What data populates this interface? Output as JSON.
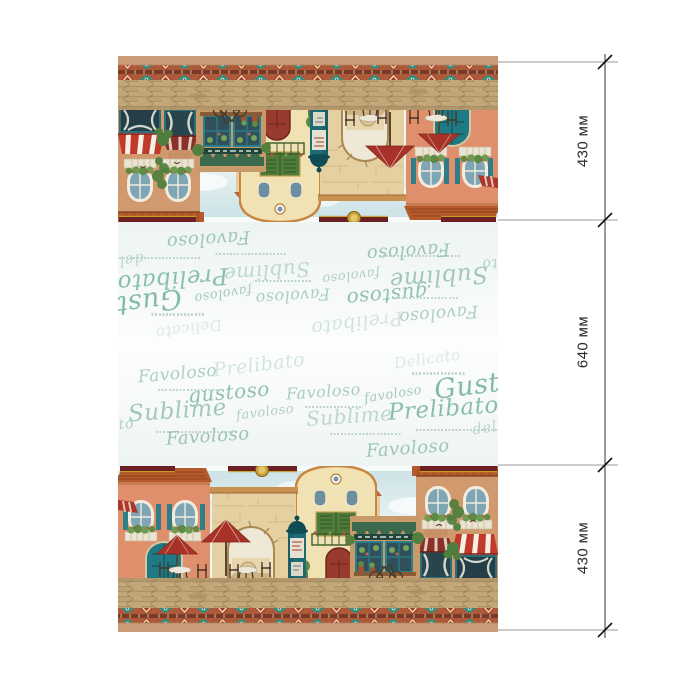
{
  "dimensions": {
    "sections": [
      {
        "label": "430 мм",
        "part": "top-scene"
      },
      {
        "label": "640 мм",
        "part": "middle-words"
      },
      {
        "label": "430 мм",
        "part": "bottom-scene"
      }
    ],
    "line_color": "#444444",
    "tick_color": "#111111",
    "text_color": "#2b2b2b"
  },
  "fabric": {
    "script_words": [
      {
        "t": "Favoloso",
        "x": 20,
        "y": 22,
        "s": 17,
        "r": -5,
        "c": "#9fc7b5",
        "o": 0.85,
        "cap": true
      },
      {
        "t": "Prelibato",
        "x": 95,
        "y": 12,
        "s": 19,
        "r": -7,
        "c": "#cfe3da",
        "o": 0.9,
        "cap": false
      },
      {
        "t": "Delicato",
        "x": 276,
        "y": 8,
        "s": 15,
        "r": -8,
        "c": "#d8e8e0",
        "o": 0.9,
        "cap": true
      },
      {
        "t": "gustoso",
        "x": 70,
        "y": 38,
        "s": 20,
        "r": -5,
        "c": "#8abfab",
        "o": 0.95,
        "cap": false
      },
      {
        "t": "Favoloso",
        "x": 168,
        "y": 40,
        "s": 16,
        "r": -4,
        "c": "#a4c9b8",
        "o": 0.9,
        "cap": true
      },
      {
        "t": "favoloso",
        "x": 246,
        "y": 44,
        "s": 13,
        "r": -9,
        "c": "#9cc3b2",
        "o": 0.9,
        "cap": false
      },
      {
        "t": "Gustoso",
        "x": 316,
        "y": 26,
        "s": 27,
        "r": -7,
        "c": "#7db8a3",
        "o": 0.95,
        "cap": false
      },
      {
        "t": "Sublime",
        "x": 10,
        "y": 56,
        "s": 23,
        "r": -4,
        "c": "#9cc6b4",
        "o": 0.95,
        "cap": true
      },
      {
        "t": "favoloso",
        "x": 118,
        "y": 62,
        "s": 13,
        "r": -7,
        "c": "#a9cbbb",
        "o": 0.9,
        "cap": false
      },
      {
        "t": "Sublime",
        "x": 188,
        "y": 62,
        "s": 20,
        "r": -4,
        "c": "#bad7cb",
        "o": 0.95,
        "cap": true
      },
      {
        "t": "Prelibato",
        "x": 270,
        "y": 54,
        "s": 23,
        "r": -4,
        "c": "#85bba7",
        "o": 0.95,
        "cap": true
      },
      {
        "t": "delicato",
        "x": 354,
        "y": 74,
        "s": 15,
        "r": -8,
        "c": "#b7d5c9",
        "o": 0.9,
        "cap": false
      },
      {
        "t": "ato",
        "x": -8,
        "y": 74,
        "s": 14,
        "r": -6,
        "c": "#a9cdbd",
        "o": 0.9,
        "cap": false
      },
      {
        "t": "Favoloso",
        "x": 48,
        "y": 84,
        "s": 18,
        "r": -4,
        "c": "#97c2b0",
        "o": 0.95,
        "cap": false
      },
      {
        "t": "Favoloso",
        "x": 248,
        "y": 96,
        "s": 18,
        "r": -4,
        "c": "#9ac4b2",
        "o": 0.95,
        "cap": false
      }
    ],
    "palette": {
      "tan_edge": "#c99c77",
      "border_ground": "#ad5a3a",
      "border_dark": "#7c3a24",
      "rosette_teal": "#2e9187",
      "diamond_cream": "#e9d8ae",
      "maroon_strip": "#6d2023",
      "medallion_gold": "#caa23a",
      "roof_orange": "#b55a2b",
      "facade_salmon": "#e08f6c",
      "facade_cream": "#f0e2b2",
      "facade_terracotta": "#d0996e",
      "stone_arch": "#e5d0a2",
      "door_teal": "#1f7a85",
      "umbrella_red": "#a93228",
      "awning_red": "#c0392b",
      "awning_green": "#3c6a4d",
      "cobble": "#c4a978",
      "sky": "#cde3e7",
      "words_green": "#8abfab",
      "words_bg": "#f5f9f7"
    }
  }
}
